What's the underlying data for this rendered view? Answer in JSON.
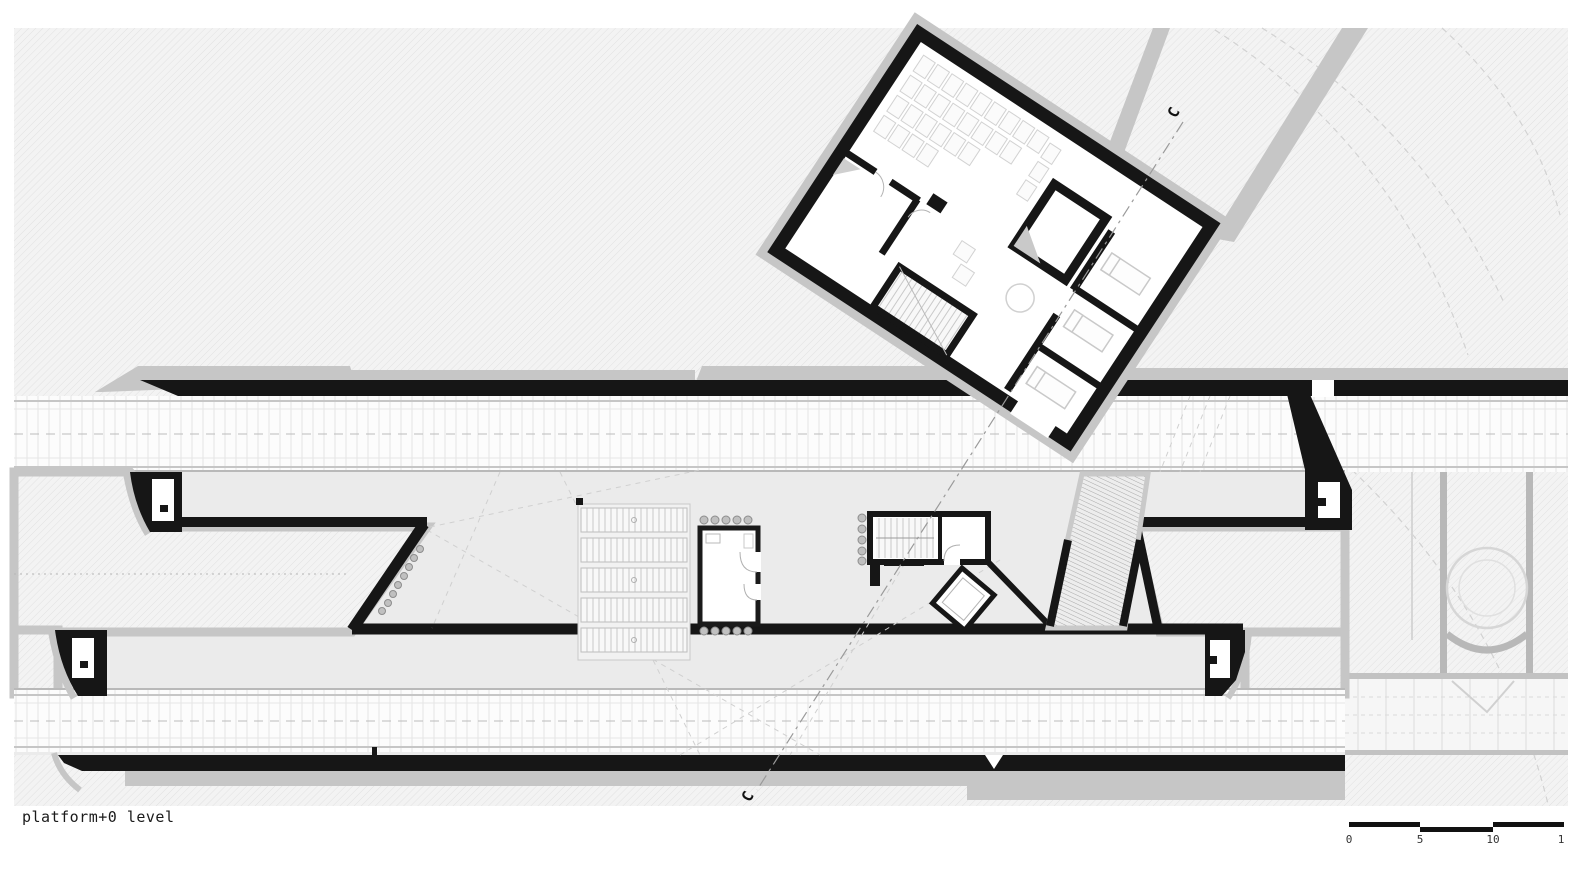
{
  "title_label": "platform+0 level",
  "section_markers": {
    "top": "C",
    "bottom": "C"
  },
  "scale_bar": {
    "labels": [
      "0",
      "5",
      "10",
      "1"
    ]
  },
  "legend_colors": {
    "page_background": "#ffffff",
    "hatch_background": "#f3f3f3",
    "hatch_line": "#e1e1e1",
    "platform_fill": "#ebebeb",
    "track_fill": "#fcfcfc",
    "wall_black": "#161616",
    "concrete_gray": "#c6c6c6"
  }
}
